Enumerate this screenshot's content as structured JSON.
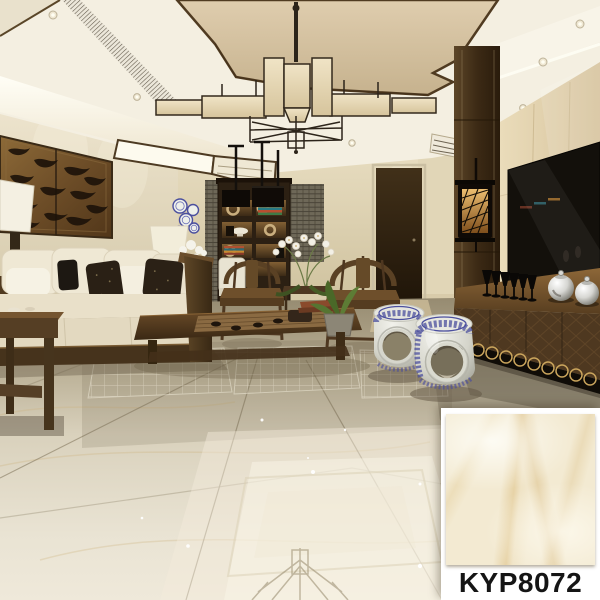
{
  "image": {
    "kind": "interior-showroom-photograph",
    "description": "Chinese-style living room with glossy marble-look tile floor; product swatch inset at bottom right",
    "width": 600,
    "height": 600
  },
  "product": {
    "code": "KYP8072"
  },
  "swatch_card": {
    "label": "KYP8072"
  },
  "palette": {
    "card-bg": "#ffffff",
    "label-color": "#151515",
    "tile-base": "#f3ead2",
    "tile-vein": "#d6b26a",
    "ceiling-tan": "#d8c5a3",
    "cove-white": "#fbf8ee",
    "trim-wood": "#4d3a21",
    "wall-cream": "#e6dcc1",
    "bronze-panel": "#7a5930",
    "wood-dark": "#4a351d",
    "floor-light": "#ece6d6",
    "floor-dark": "#a2967c",
    "porcelain-blue": "#4b4f9e",
    "tv-black": "#13100b",
    "marble-wall": "#e7d9ba",
    "silver": "#d8d8d4"
  },
  "scene": {
    "elements": [
      "ceiling-cove",
      "air-vent",
      "chandelier",
      "carved-wall-panel",
      "table-lamps",
      "sofa",
      "throw-pillows",
      "side-table",
      "display-cabinet",
      "pendant-lights",
      "dining-chair",
      "orchid-arrangement",
      "ming-armchairs",
      "tea-table",
      "bonsai-plant",
      "porcelain-drum-stools",
      "lantern-sconce",
      "marble-tv-wall",
      "tv-screen",
      "tv-cabinet",
      "black-goblets",
      "silver-teapots",
      "glossy-tile-floor"
    ]
  }
}
